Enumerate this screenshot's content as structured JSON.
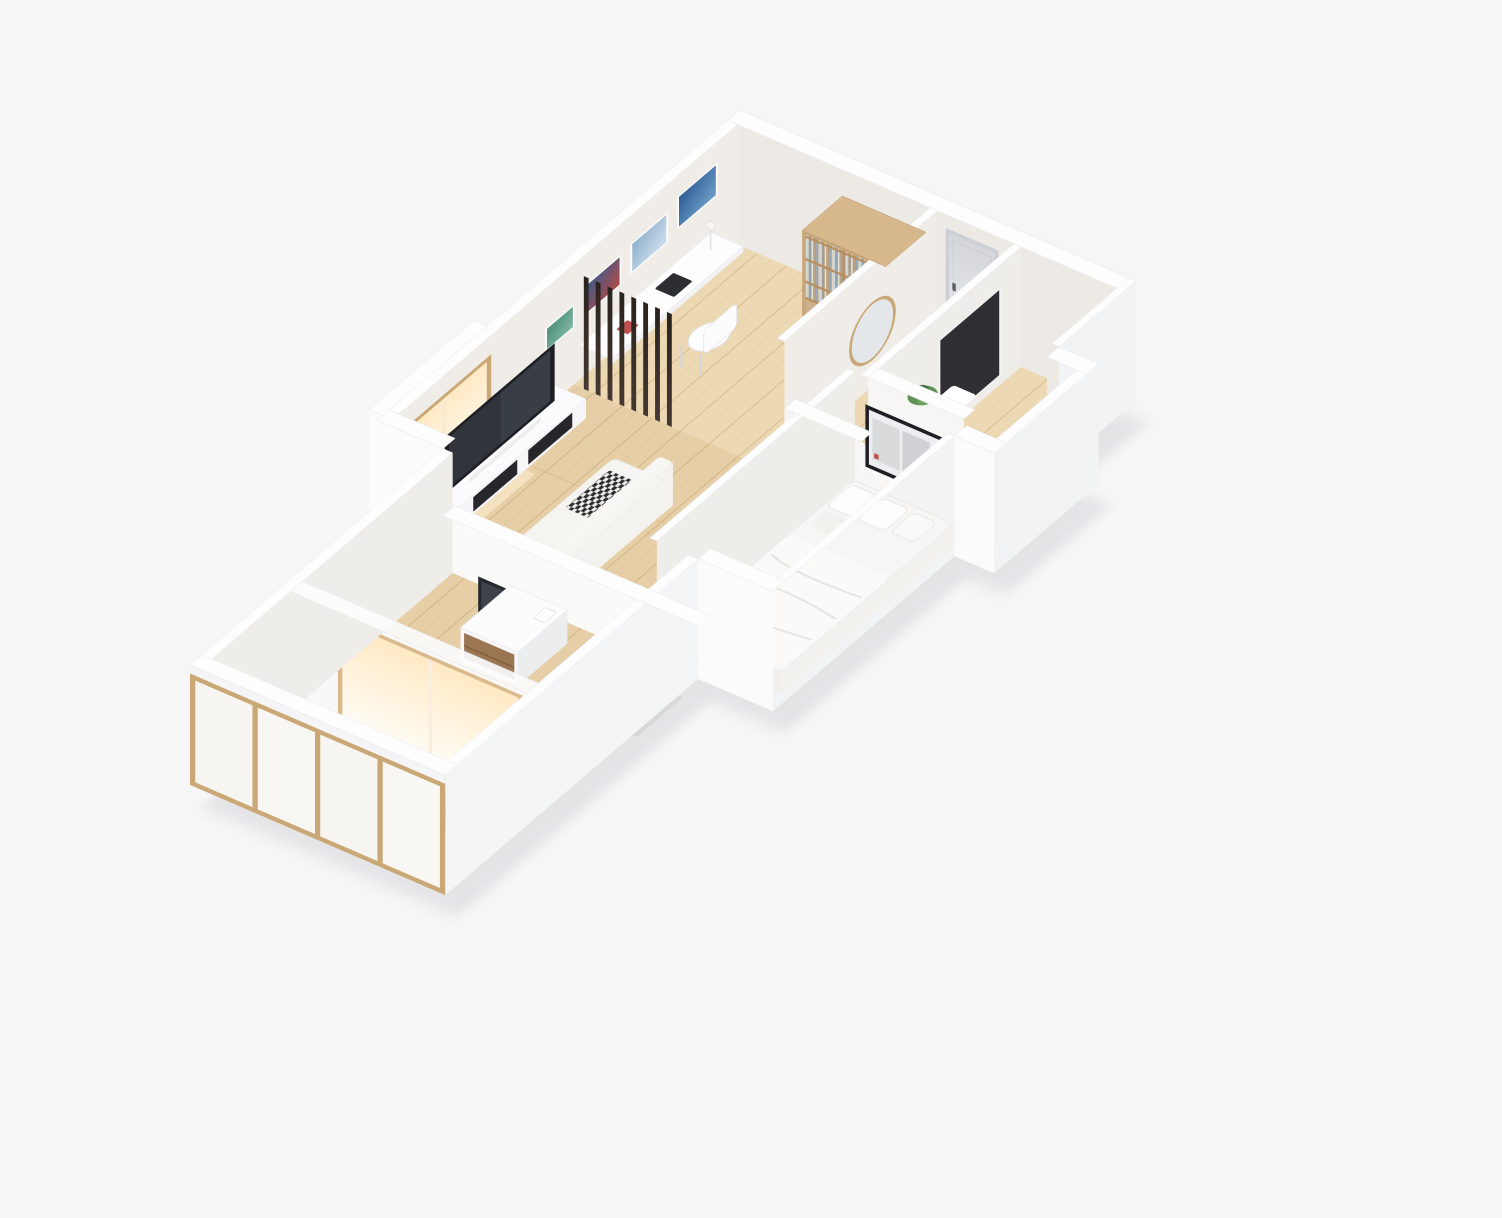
{
  "scene": {
    "kind": "isometric-apartment-floor-plan-render",
    "background": "#f6f6f7",
    "objects": [
      "study-room",
      "living-room",
      "hallway",
      "bathroom",
      "bedroom",
      "south-room",
      "balcony",
      "bookshelf",
      "desk",
      "desk-chair",
      "desk-lamp",
      "laptop",
      "wall-art",
      "slat-divider",
      "tv",
      "tv-console",
      "sofa",
      "window-bay",
      "entry-door",
      "mirror",
      "toilet",
      "bath-panel",
      "white-cabinet",
      "bed",
      "pillows",
      "bedroom-tv",
      "wall-shelf-books",
      "media-console",
      "monitor",
      "side-table",
      "books",
      "bench",
      "rug",
      "potted-plant",
      "glazed-facade",
      "window-wall"
    ]
  },
  "palette": {
    "background": "#f6f6f7",
    "shadow": "#d9d9de",
    "wall_top": "#fdfdfe",
    "wall_inner_warm": "#edeae6",
    "wall_inner_side": "#f0ede8",
    "wall_bright": "#fbfbfc",
    "wood_study": "#ecd8b2",
    "wood_living": "#e6cfa6",
    "wood_balcony": "#f0deba",
    "wood_line_a": "#d6b887",
    "wood_line_b": "#cfae7e",
    "wood_line_c": "#dcc192",
    "shelf_wood": "#c9a677",
    "shelf_wood_top": "#d7b88c",
    "facade_frame": "#c9a876",
    "slat_dark": "#2a221d",
    "slat_light": "#453931",
    "tv_frame": "#1d1f24",
    "tv_screen": "#31343b",
    "accent_red": "#c0504d",
    "accent_blue": "#3a5fa8",
    "accent_green": "#4e9e57",
    "accent_teal": "#3f8f86",
    "plant_green": "#55894b",
    "glow_warm": "#ffe9c4",
    "door_gray": "#e0e3e7"
  }
}
